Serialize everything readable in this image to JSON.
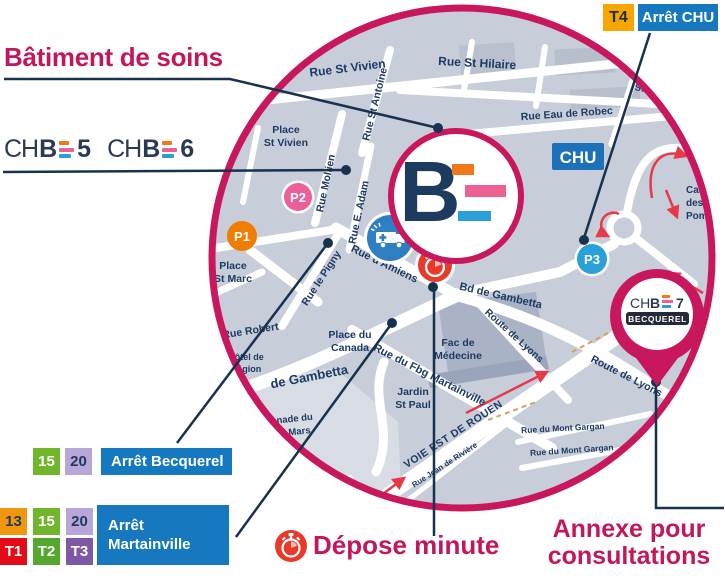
{
  "title": "Bâtiment de soins",
  "colors": {
    "magenta": "#c2185b",
    "circle_border": "#c8175d",
    "navy_text": "#1d3a63",
    "pointer_line": "#16324f",
    "stop_blue": "#1678be",
    "chu_blue": "#1d71b8",
    "t4_yellow": "#f7a600",
    "p1_orange": "#ef7d00",
    "p2_pink": "#ec5f9b",
    "p3_blue": "#29a0d8",
    "ambulance_blue": "#2e7fc2",
    "stopwatch_red": "#e8392b",
    "arrow_red": "#e8394a",
    "map_gray": "#c7cdd9",
    "badge_15_green": "#71b52b",
    "badge_20_lavender": "#b9a6d9",
    "badge_13_orange": "#f0960f",
    "badge_t1_red": "#e30b17",
    "badge_t2_green": "#53a82d",
    "badge_t3_purple": "#7d59a5"
  },
  "legend": {
    "chb5": {
      "ch": "CH",
      "b": "B",
      "num": "5"
    },
    "chb6": {
      "ch": "CH",
      "b": "B",
      "num": "6"
    },
    "stop_chu": {
      "badge": "T4",
      "label": "Arrêt CHU"
    },
    "stop_becquerel": {
      "badges": [
        "15",
        "20"
      ],
      "label": "Arrêt Becquerel"
    },
    "stop_martainville": {
      "badges_top": [
        "13",
        "15",
        "20"
      ],
      "badges_bottom": [
        "T1",
        "T2",
        "T3"
      ],
      "label1": "Arrêt",
      "label2": "Martainville"
    },
    "depose_minute": "Dépose minute",
    "annexe1": "Annexe pour",
    "annexe2": "consultations"
  },
  "map": {
    "chu": "CHU",
    "parkings": {
      "p1": "P1",
      "p2": "P2",
      "p3": "P3"
    },
    "pin": {
      "ch": "CH",
      "b": "B",
      "num": "7",
      "sub": "BECQUEREL"
    },
    "center_logo": {
      "b": "B"
    },
    "streets": {
      "rue_st_vivien": "Rue St Vivien",
      "rue_st_hilaire": "Rue St Hilaire",
      "st_hilaire_partial": "St Hi",
      "rue_eau_de_robec": "Rue Eau de Robec",
      "place_st_vivien_1": "Place",
      "place_st_vivien_2": "St Vivien",
      "rue_mollien": "Rue Mollien",
      "rue_st_antoine": "Rue St Antoine",
      "rue_e_adam": "Rue E. Adam",
      "rue_d_amiens": "Rue d'Amiens",
      "rue_le_pigny": "Rue le Pigny",
      "place_st_marc_1": "Place",
      "place_st_marc_2": "St Marc",
      "rue_robert": "Rue Robert",
      "hotel_region_1": "Hôtel de",
      "hotel_region_2": "Région",
      "bd_gambetta_w": "de Gambetta",
      "bd_gambetta_e": "Bd de Gambetta",
      "route_lyons_n": "Route de Lyons",
      "route_lyons_s": "Route de Lyons",
      "place_canada_1": "Place du",
      "place_canada_2": "Canada",
      "fac_medecine_1": "Fac de",
      "fac_medecine_2": "Médecine",
      "jardin_1": "Jardin",
      "jardin_2": "St Paul",
      "fbg_martainville": "Rue du Fbg Martainville",
      "voie_est": "VOIE EST DE ROUEN",
      "rue_riviere": "Rue Jean de Rivière",
      "mont_gargan_1": "Rue du Mont Gargan",
      "mont_gargan_2": "Rue du Mont Gargan",
      "esplanade_1": "lanade du",
      "esplanade_2": "de Mars",
      "caserne_1": "Case",
      "caserne_2": "des",
      "caserne_3": "Pompi"
    }
  }
}
